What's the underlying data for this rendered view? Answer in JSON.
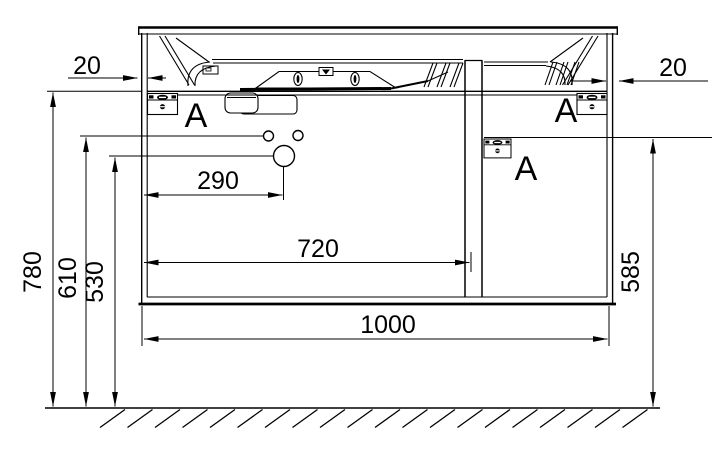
{
  "drawing": {
    "background": "#ffffff",
    "line_color": "#000000",
    "dimensions": {
      "left_overhang": "20",
      "right_overhang": "20",
      "faucet_offset": "290",
      "inner_width": "720",
      "total_width": "1000",
      "total_height": "780",
      "holes_height": "610",
      "faucet_height": "530",
      "right_panel_height": "585"
    },
    "callouts": {
      "hinge_left": "A",
      "hinge_right": "A",
      "hinge_center": "A"
    }
  }
}
